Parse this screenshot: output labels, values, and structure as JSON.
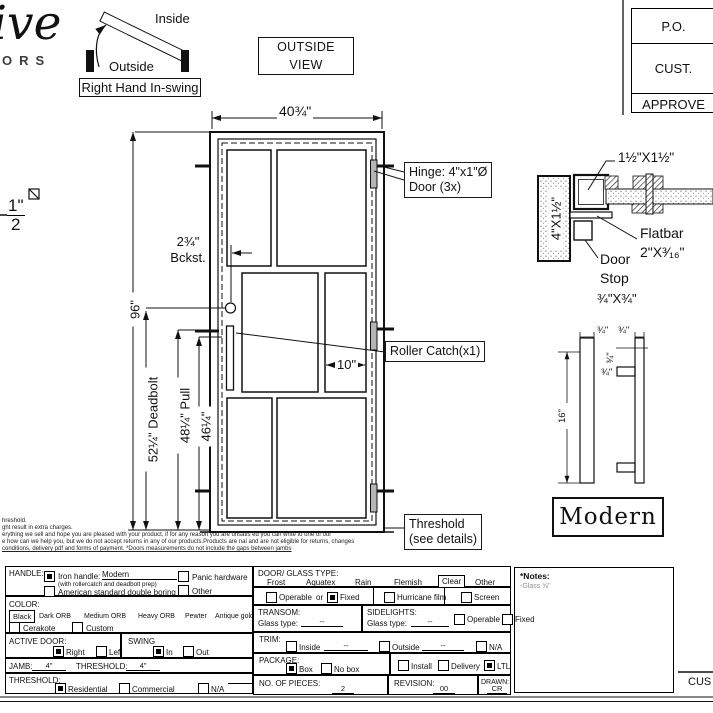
{
  "logo": {
    "script": "ive",
    "letters": "ORS"
  },
  "swing_diagram": {
    "inside": "Inside",
    "outside": "Outside",
    "caption": "Right Hand In-swing"
  },
  "view_box": "OUTSIDE VIEW",
  "title_block": [
    "P.O.",
    "CUST.",
    "APPROVE"
  ],
  "fragment": {
    "num": "1\"",
    "den": "2"
  },
  "door": {
    "width_dim": "40¾\"",
    "height_dim": "96\"",
    "deadbolt_dim": "52¼\" Deadbolt",
    "pull_dim": "48¼\" Pull",
    "pull2_dim": "46¼\"",
    "backset_dim": "2¾\"",
    "backset_label": "Bckst.",
    "panel_dim": "10\"",
    "hinge_line1": "Hinge: 4\"x1\"Ø",
    "hinge_line2": "Door (3x)",
    "roller_label": "Roller Catch(x1)",
    "threshold_line1": "Threshold",
    "threshold_line2": "(see details)"
  },
  "jamb_detail": {
    "tube": "1½\"X1½\"",
    "post": "4\"X1½\"",
    "flatbar1": "Flatbar",
    "flatbar2": "2\"X³⁄₁₆\"",
    "stop1": "Door",
    "stop2": "Stop",
    "stop3": "¾\"X¾\""
  },
  "handle_detail": {
    "length": "16\"",
    "d1": "¾\"",
    "d2": "¾\"",
    "d3": "¾\"",
    "d4": "¾\"",
    "name": "Modern"
  },
  "disclaimer": [
    "hreshold.",
    "ght result in extra charges.",
    "erything we sell and hope you are pleased with your product, if for any reason you are unsatis  ed you can write to one of our",
    "e how can we help you, but we do not accept returns in any of our products.Products are   nal and are not eligible for returns, changes",
    " conditions, delivery pdf and forms of payment. *Doors measurements do not include the gaps between jambs"
  ],
  "form": {
    "handle": {
      "label": "HANDLE:",
      "iron": "Iron handle:",
      "iron_value": "Modern",
      "iron_sub": "(with rollercatch and deadbolt prep)",
      "american": "American standard double boring",
      "panic": "Panic hardware",
      "other": "Other"
    },
    "color": {
      "label": "COLOR:",
      "options": [
        "Black",
        "Dark ORB",
        "Medium ORB",
        "Heavy ORB",
        "Pewter",
        "Antique gold"
      ],
      "cerakote": "Cerakote",
      "custom": "Custom"
    },
    "active": {
      "label": "ACTIVE DOOR:",
      "right": "Right",
      "left": "Left"
    },
    "swing": {
      "label": "SWING",
      "in": "In",
      "out": "Out"
    },
    "jamb": {
      "label": "JAMB:",
      "value": "4\"",
      "t_label": "THRESHOLD:",
      "t_value": "4\""
    },
    "threshold": {
      "label": "THRESHOLD:",
      "residential": "Residential",
      "commercial": "Commercial",
      "na": "N/A"
    },
    "glass": {
      "label": "DOOR/ GLASS TYPE:",
      "types": [
        "Frost",
        "Aquatex",
        "Rain",
        "Flemish",
        "Clear",
        "Other"
      ],
      "operable": "Operable",
      "or": "or",
      "fixed": "Fixed",
      "hurricane": "Hurricane film",
      "screen": "Screen"
    },
    "transom": {
      "label": "TRANSOM:",
      "glass_type": "Glass type:",
      "value": "--"
    },
    "sidelights": {
      "label": "SIDELIGHTS:",
      "glass_type": "Glass type:",
      "value": "--",
      "operable": "Operable",
      "fixed": "Fixed"
    },
    "trim": {
      "label": "TRIM:",
      "inside": "Inside",
      "inside_value": "--",
      "outside": "Outside",
      "outside_value": "--",
      "na": "N/A"
    },
    "package": {
      "label": "PACKAGE:",
      "box": "Box",
      "nobox": "No box",
      "install": "Install",
      "delivery": "Delivery",
      "ltl": "LTL"
    },
    "pieces": {
      "label": "NO. OF  PIECES:",
      "value": "2"
    },
    "revision": {
      "label": "REVISION:",
      "value": "00"
    },
    "drawn": {
      "label": "DRAWN:",
      "value": "CR"
    }
  },
  "notes": {
    "title": "*Notes:",
    "line": "-Glass ⅝\""
  },
  "signature": "CUS"
}
